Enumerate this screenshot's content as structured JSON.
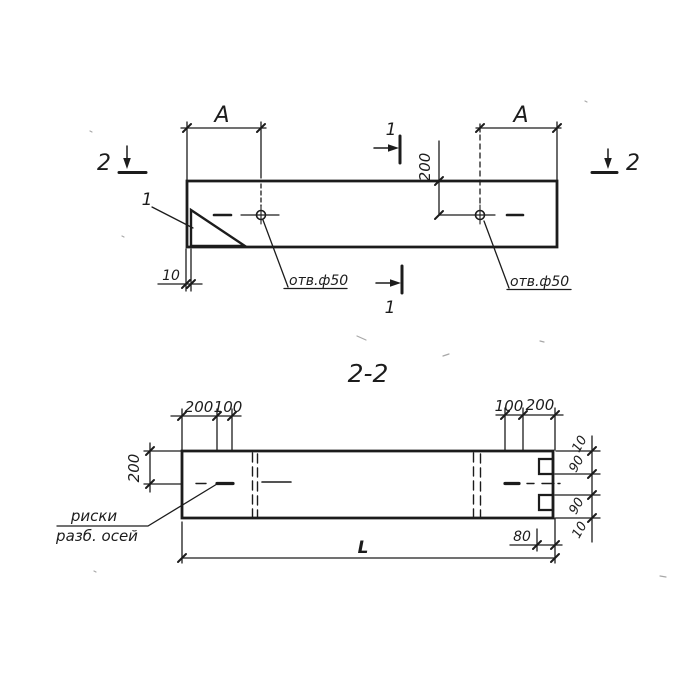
{
  "colors": {
    "ink": "#1c1c1c",
    "paper": "#ffffff"
  },
  "plan_view": {
    "dim_a_left": "А",
    "dim_a_right": "А",
    "dim_hole_offset": "200",
    "dim_chamfer_width": "10",
    "hole_note_left": "отв.ф50",
    "hole_note_right": "отв.ф50",
    "chamfer_callout": "1",
    "section_mark_1_top": "1",
    "section_mark_1_bottom": "1",
    "section_mark_2_left": "2",
    "section_mark_2_right": "2"
  },
  "section_view": {
    "title": "2-2",
    "dim_top_left_200": "200",
    "dim_top_left_100": "100",
    "dim_top_right_100": "100",
    "dim_top_right_200": "200",
    "dim_height_200": "200",
    "dim_right_edge_top_10": "10",
    "dim_right_notch_top_90": "90",
    "dim_right_notch_bottom_90": "90",
    "dim_right_edge_bottom_10": "10",
    "dim_notch_depth_80": "80",
    "dim_total_length": "L",
    "axis_note_line1": "риски",
    "axis_note_line2": "разб. осей"
  }
}
